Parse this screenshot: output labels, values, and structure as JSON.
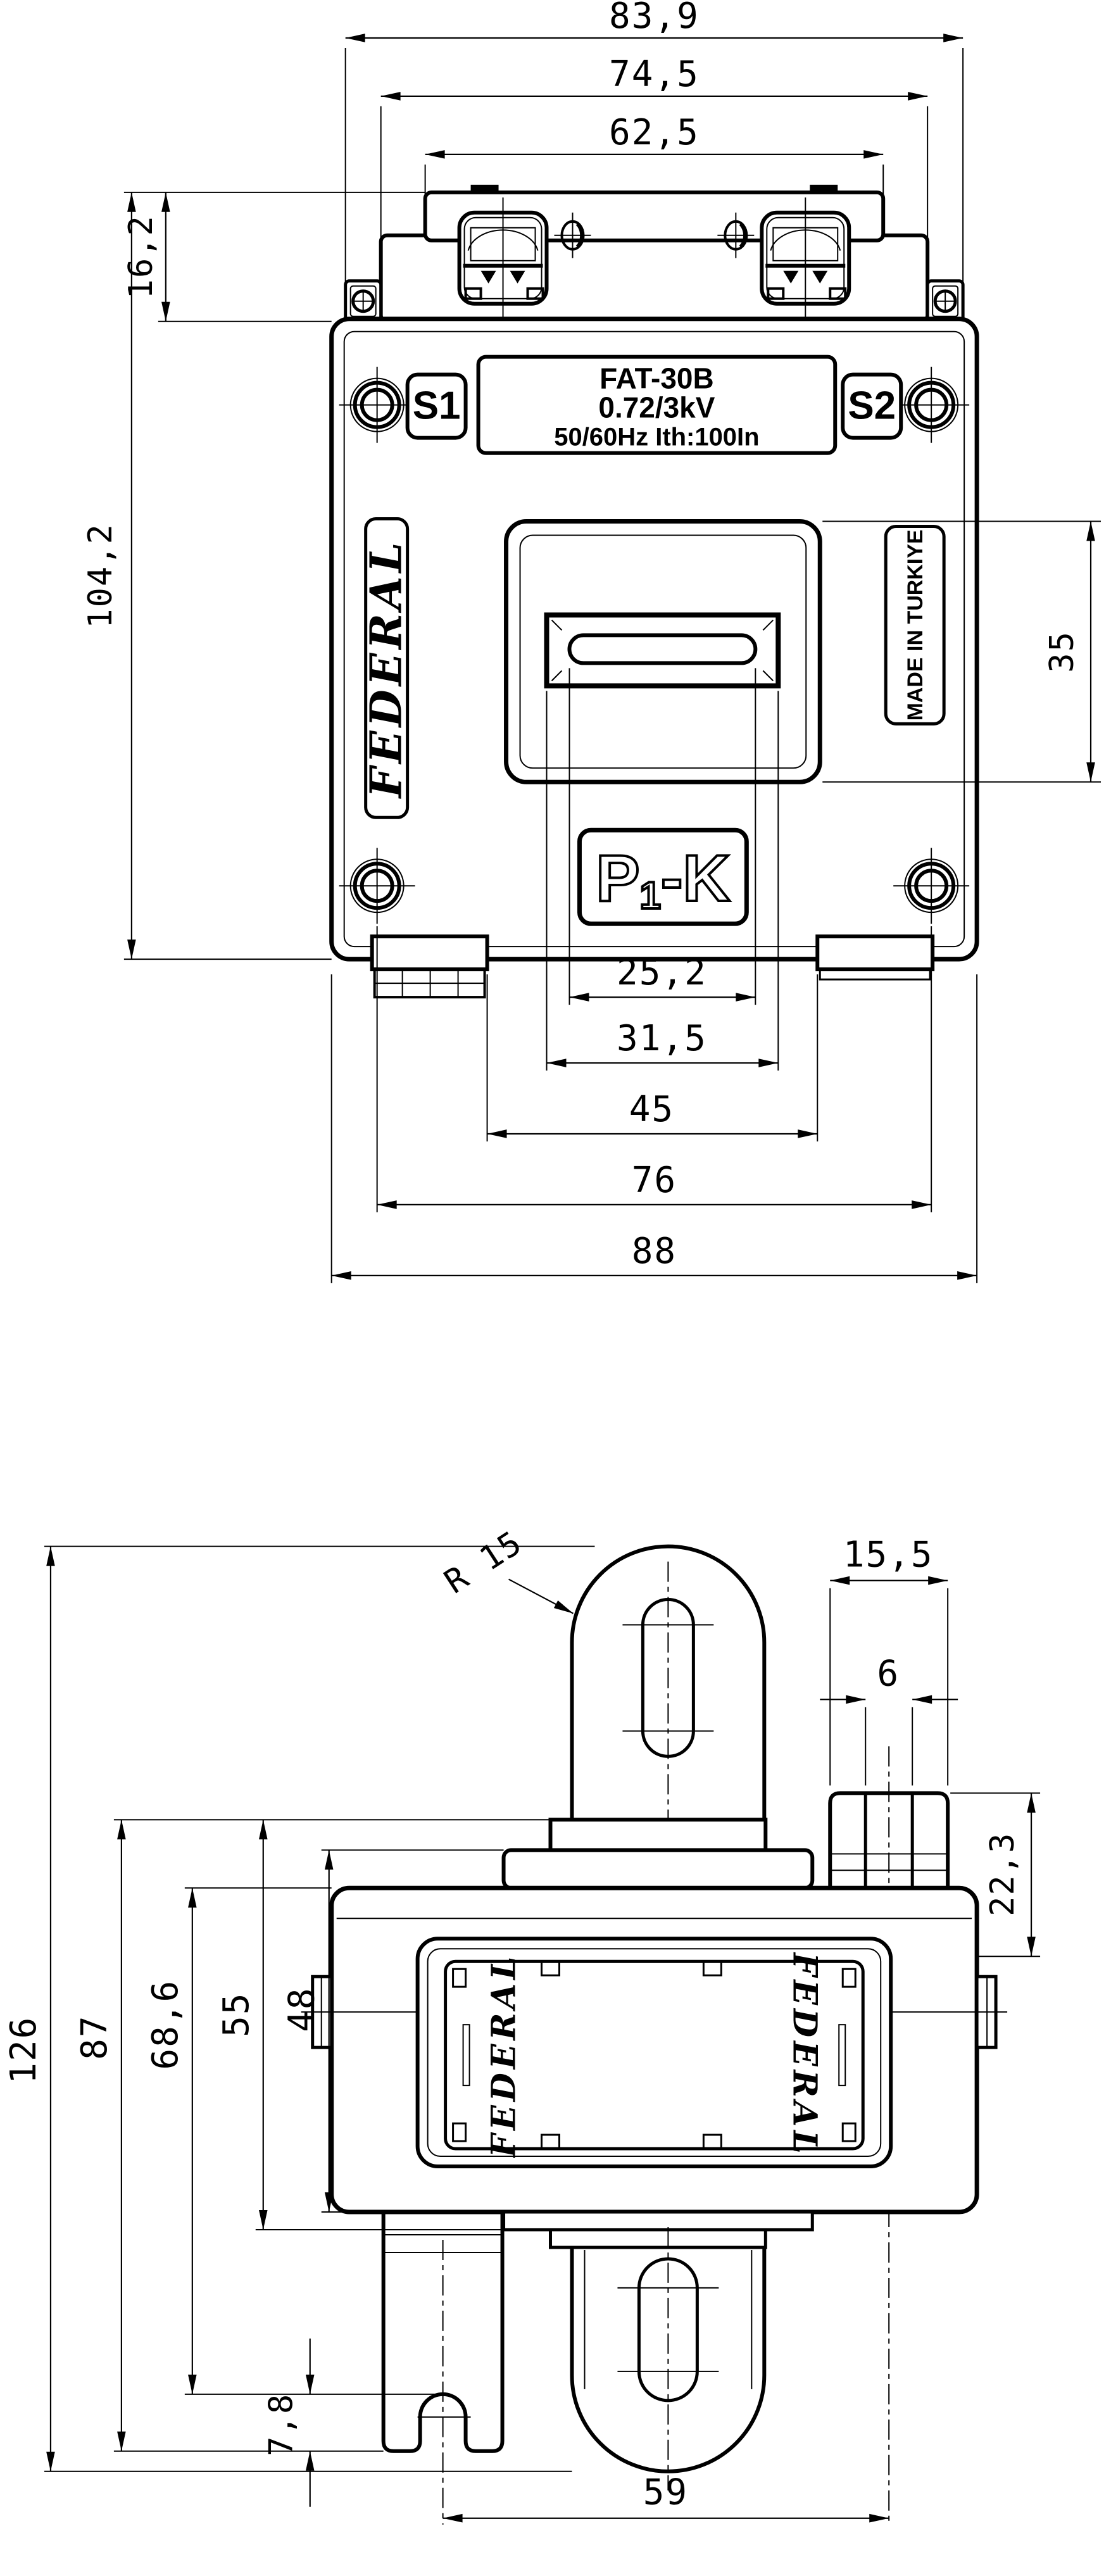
{
  "colors": {
    "background": "#ffffff",
    "line": "#000000"
  },
  "drawing_title": "FAT-30B current transformer outline drawing",
  "fv": {
    "dims": {
      "w839": "83,9",
      "w745": "74,5",
      "w625": "62,5",
      "h162": "16,2",
      "h1042": "104,2",
      "h35": "35",
      "w252": "25,2",
      "w315": "31,5",
      "w45": "45",
      "w76": "76",
      "w88": "88"
    },
    "plate1": "FAT-30B",
    "plate2": "0.72/3kV",
    "plate3": "50/60Hz Ith:100In",
    "s1": "S1",
    "s2": "S2",
    "federal": "FEDERAL",
    "madein": "MADE IN TURKIYE",
    "p1k_p": "P",
    "p1k_sub": "1",
    "p1k_rest": "-K"
  },
  "sv": {
    "dims": {
      "w155": "15,5",
      "w6": "6",
      "h223": "22,3",
      "h126": "126",
      "h87": "87",
      "h686": "68,6",
      "h55": "55",
      "h48": "48",
      "h78": "7,8",
      "w59": "59",
      "r15": "R 15"
    },
    "federal_left": "FEDERAL",
    "federal_right": "FEDERAL"
  }
}
